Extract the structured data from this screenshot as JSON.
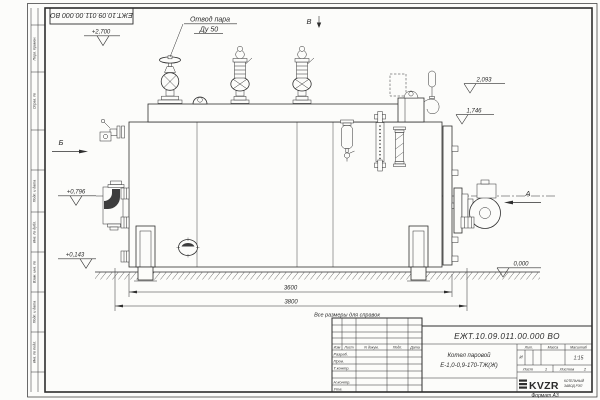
{
  "sheet": {
    "top_designation": "ЕЖТ.10.09.011.00.000  ВО",
    "format_note": "Формат А3",
    "margin_labels": [
      "Перв. примен.",
      "Справ. №",
      "Подп. и дата",
      "Инв. № дубл.",
      "Взам. инв. №",
      "Подп. и дата",
      "Инв. № подл."
    ]
  },
  "labels": {
    "steam_outlet_1": "Отвод пара",
    "steam_outlet_2": "Ду 50",
    "view_a": "А",
    "view_b": "Б",
    "view_v": "В",
    "reference_note": "Все размеры для справок"
  },
  "elevations": {
    "top": "+2,700",
    "fittings": "2,093",
    "shell_top": "1,746",
    "nozzle": "+0,796",
    "lower": "+0,143",
    "ground": "0,000"
  },
  "dimensions": {
    "shell_length": "3600",
    "overall_length": "3800"
  },
  "title_block": {
    "designation": "ЕЖТ.10.09.011.00.000  ВО",
    "product_name_1": "Котел паровой",
    "product_name_2": "Е-1,0-0,9-170-ТЖ(Ж)",
    "cols": {
      "izm": "Изм",
      "list": "Лист",
      "doc": "N докум.",
      "sign": "Подп.",
      "date": "Дата"
    },
    "rows": {
      "razrab": "Разраб.",
      "prov": "Пров.",
      "tkontr": "Т.контр.",
      "nkontr": "Н.контр.",
      "utv": "Утв."
    },
    "lit_h": "Лит.",
    "mass_h": "Масса",
    "scale_h": "Масштаб",
    "lit_v": "И",
    "scale_v": "1:15",
    "sheet_h": "Лист",
    "sheet_v": "1",
    "sheets_h": "Листов",
    "sheets_v": "2",
    "logo": "KVZR",
    "company_1": "КОТЕЛЬНЫЙ",
    "company_2": "ЗАВОД РЭП"
  }
}
